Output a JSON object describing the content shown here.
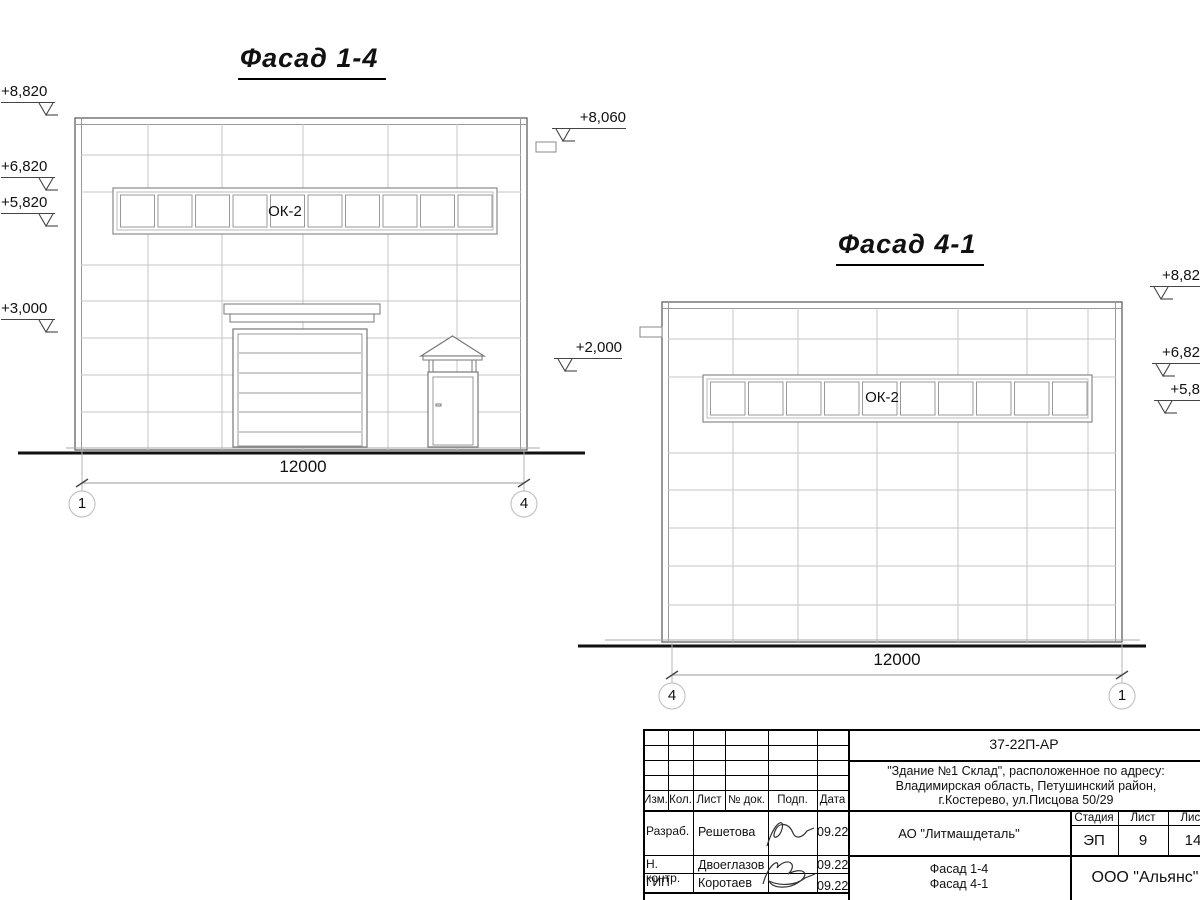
{
  "facade14": {
    "title": "Фасад 1-4",
    "window_label": "ОК-2",
    "dimension": "12000",
    "axis_left": "1",
    "axis_right": "4",
    "elev_8820": "+8,820",
    "elev_6820": "+6,820",
    "elev_5820": "+5,820",
    "elev_3000": "+3,000",
    "elev_8060": "+8,060",
    "elev_2000": "+2,000"
  },
  "facade41": {
    "title": "Фасад 4-1",
    "window_label": "ОК-2",
    "dimension": "12000",
    "axis_left": "4",
    "axis_right": "1",
    "elev_top": "+8,82",
    "elev_mid": "+6,82",
    "elev_low": "+5,8"
  },
  "title_block": {
    "doc_number": "37-22П-АР",
    "address_line1": "\"Здание №1 Склад\", расположенное по адресу:",
    "address_line2": "Владимирская область, Петушинский район,",
    "address_line3": "г.Костерево, ул.Писцова 50/29",
    "col_izm": "Изм.",
    "col_kol": "Кол.",
    "col_list": "Лист",
    "col_doc": "№ док.",
    "col_podp": "Подп.",
    "col_data": "Дата",
    "row1_role": "Разраб.",
    "row1_name": "Решетова",
    "row1_date": "09.22",
    "row2_role": "Н. контр.",
    "row2_name": "Двоеглазов",
    "row2_date": "09.22",
    "row3_role": "ГИП",
    "row3_name": "Коротаев",
    "row3_date": "09.22",
    "company": "АО \"Литмашдеталь\"",
    "stage_label": "Стадия",
    "sheet_label": "Лист",
    "sheets_label": "Лист",
    "stage_value": "ЭП",
    "sheet_value": "9",
    "sheets_value": "14",
    "drawing_title_line1": "Фасад 1-4",
    "drawing_title_line2": "Фасад 4-1",
    "org": "ООО \"Альянс\""
  }
}
